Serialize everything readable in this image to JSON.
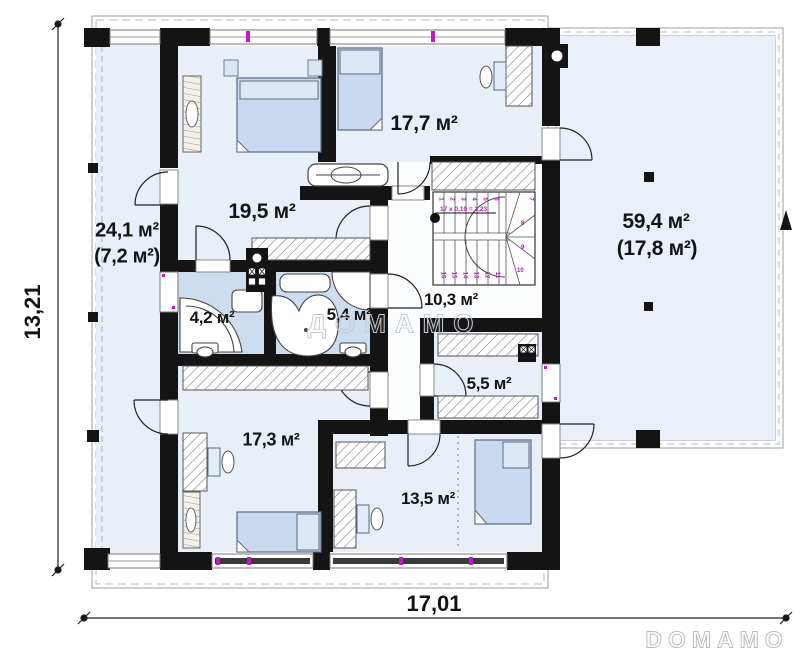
{
  "plan": {
    "dimensions": {
      "width_total": "17,01",
      "height_total": "13,21"
    },
    "rooms": [
      {
        "key": "attic-left",
        "area": "24,1 м²",
        "area_secondary": "(7,2 м²)"
      },
      {
        "key": "bedroom-1",
        "area": "19,5 м²"
      },
      {
        "key": "bedroom-2",
        "area": "17,7 м²"
      },
      {
        "key": "terrace",
        "area": "59,4 м²",
        "area_secondary": "(17,8 м²)"
      },
      {
        "key": "hall-stairs",
        "area": "10,3 м²"
      },
      {
        "key": "bathroom-small",
        "area": "4,2 м²"
      },
      {
        "key": "bathroom-large",
        "area": "5,4 м²"
      },
      {
        "key": "wardrobe-room",
        "area": "5,5 м²"
      },
      {
        "key": "bedroom-3",
        "area": "17,3 м²"
      },
      {
        "key": "bedroom-4",
        "area": "13,5 м²"
      }
    ],
    "stairs": {
      "note": "17 x 0,19 = 3,23",
      "numbers": [
        "1",
        "2",
        "3",
        "4",
        "5",
        "6",
        "7",
        "8",
        "9",
        "10",
        "11",
        "12",
        "13",
        "14",
        "15",
        "16"
      ]
    },
    "watermarks": {
      "center": "ДОМАМО",
      "logo": "DOMAMO"
    },
    "colors": {
      "wall": "#141414",
      "room_fill": "#e8eff9",
      "bath_fill": "#ccddef",
      "furniture_fill": "#c9daf0",
      "accent_magenta": "#b317b3"
    }
  }
}
